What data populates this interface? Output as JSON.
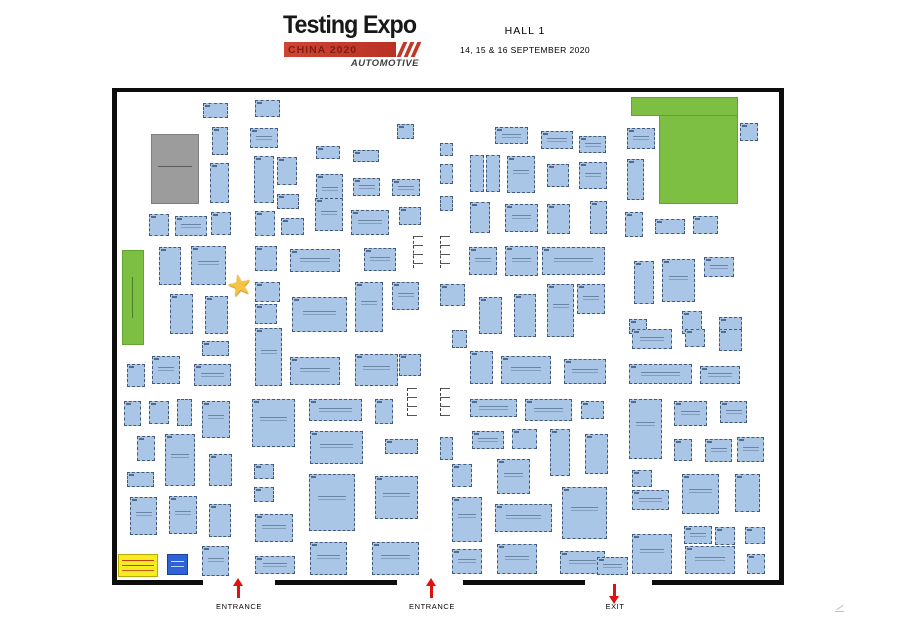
{
  "header": {
    "logo_title": "Testing Expo",
    "logo_banner": "CHINA 2020",
    "logo_sub": "AUTOMOTIVE",
    "hall": "HALL 1",
    "dates": "14, 15 & 16 SEPTEMBER 2020"
  },
  "colors": {
    "booth_fill": "#a9c6e6",
    "booth_border": "#47597a",
    "green_area": "#7cbf42",
    "gray_block": "#9c9c9c",
    "legend_yellow": "#f7ec20",
    "legend_blue": "#2e63d8",
    "arrow_red": "#e01111",
    "wall_black": "#0d0d0d"
  },
  "map": {
    "relaxation_label": "VISITOR\nRELAXATION\nAREA",
    "walls": [
      [
        112,
        88,
        672,
        4
      ],
      [
        112,
        88,
        5,
        497
      ],
      [
        779,
        88,
        5,
        497
      ],
      [
        112,
        580,
        91,
        5
      ],
      [
        275,
        580,
        122,
        5
      ],
      [
        463,
        580,
        122,
        5
      ],
      [
        652,
        580,
        132,
        5
      ]
    ],
    "zones": [
      {
        "name": "zone-organiser-block",
        "x": 151,
        "y": 134,
        "w": 48,
        "h": 70,
        "color": "#9c9c9c",
        "border": "#7e7e7e",
        "micro": "micro-h"
      },
      {
        "name": "zone-relaxation-strip",
        "x": 122,
        "y": 250,
        "w": 22,
        "h": 95,
        "color": "#7cbf42",
        "border": "#63a32f",
        "micro": "micro-v"
      },
      {
        "name": "zone-relaxation-top",
        "x": 631,
        "y": 97,
        "w": 107,
        "h": 19,
        "color": "#7cbf42",
        "border": "#63a32f",
        "micro": ""
      },
      {
        "name": "zone-relaxation-main",
        "x": 659,
        "y": 115,
        "w": 79,
        "h": 89,
        "color": "#7cbf42",
        "border": "#63a32f",
        "micro": ""
      },
      {
        "name": "zone-legend-yellow",
        "x": 118,
        "y": 554,
        "w": 40,
        "h": 23,
        "color": "#f7ec20",
        "border": "#b9a900",
        "micro": "micro-red"
      },
      {
        "name": "zone-legend-blue",
        "x": 167,
        "y": 554,
        "w": 21,
        "h": 21,
        "color": "#2e63d8",
        "border": "#1b3f9e",
        "micro": "micro-wht"
      }
    ],
    "joints": [
      [
        413,
        236,
        32
      ],
      [
        440,
        236,
        32
      ],
      [
        407,
        388,
        28
      ],
      [
        440,
        388,
        28
      ]
    ],
    "star": {
      "x": 227,
      "y": 272
    },
    "gates": [
      {
        "label": "ENTRANCE",
        "x": 239,
        "dir": "up"
      },
      {
        "label": "ENTRANCE",
        "x": 432,
        "dir": "up"
      },
      {
        "label": "EXIT",
        "x": 615,
        "dir": "down"
      }
    ],
    "booths": [
      [
        203,
        103,
        25,
        15
      ],
      [
        255,
        100,
        25,
        17
      ],
      [
        212,
        127,
        16,
        28
      ],
      [
        250,
        128,
        28,
        20
      ],
      [
        316,
        146,
        24,
        13
      ],
      [
        353,
        150,
        26,
        12
      ],
      [
        397,
        124,
        17,
        15
      ],
      [
        210,
        163,
        19,
        40
      ],
      [
        254,
        156,
        20,
        47
      ],
      [
        277,
        157,
        20,
        28
      ],
      [
        316,
        174,
        27,
        33
      ],
      [
        353,
        178,
        27,
        18
      ],
      [
        392,
        179,
        28,
        17
      ],
      [
        440,
        143,
        13,
        13
      ],
      [
        440,
        164,
        13,
        20
      ],
      [
        315,
        198,
        28,
        33
      ],
      [
        351,
        210,
        38,
        25
      ],
      [
        399,
        207,
        22,
        18
      ],
      [
        277,
        194,
        22,
        15
      ],
      [
        440,
        196,
        13,
        15
      ],
      [
        149,
        214,
        20,
        22
      ],
      [
        175,
        216,
        32,
        20
      ],
      [
        211,
        212,
        20,
        23
      ],
      [
        255,
        211,
        20,
        25
      ],
      [
        281,
        218,
        23,
        17
      ],
      [
        159,
        247,
        22,
        38
      ],
      [
        191,
        246,
        35,
        39
      ],
      [
        255,
        246,
        22,
        25
      ],
      [
        290,
        249,
        50,
        23
      ],
      [
        364,
        248,
        32,
        23
      ],
      [
        170,
        294,
        23,
        40
      ],
      [
        205,
        296,
        23,
        38
      ],
      [
        255,
        282,
        25,
        20
      ],
      [
        255,
        304,
        22,
        20
      ],
      [
        292,
        297,
        55,
        35
      ],
      [
        355,
        282,
        28,
        50
      ],
      [
        392,
        282,
        27,
        28
      ],
      [
        440,
        284,
        25,
        22
      ],
      [
        495,
        127,
        33,
        17
      ],
      [
        541,
        131,
        32,
        18
      ],
      [
        579,
        136,
        27,
        17
      ],
      [
        627,
        128,
        28,
        21
      ],
      [
        740,
        123,
        18,
        18
      ],
      [
        470,
        155,
        14,
        37
      ],
      [
        486,
        155,
        14,
        37
      ],
      [
        507,
        156,
        28,
        37
      ],
      [
        547,
        164,
        22,
        23
      ],
      [
        579,
        162,
        28,
        27
      ],
      [
        627,
        159,
        17,
        41
      ],
      [
        470,
        202,
        20,
        31
      ],
      [
        505,
        204,
        33,
        28
      ],
      [
        547,
        204,
        23,
        30
      ],
      [
        590,
        201,
        17,
        33
      ],
      [
        625,
        212,
        18,
        25
      ],
      [
        655,
        219,
        30,
        15
      ],
      [
        693,
        216,
        25,
        18
      ],
      [
        469,
        247,
        28,
        28
      ],
      [
        505,
        246,
        33,
        30
      ],
      [
        542,
        247,
        63,
        28
      ],
      [
        634,
        261,
        20,
        43
      ],
      [
        662,
        259,
        33,
        43
      ],
      [
        704,
        257,
        30,
        20
      ],
      [
        479,
        297,
        23,
        37
      ],
      [
        514,
        294,
        22,
        43
      ],
      [
        547,
        284,
        27,
        53
      ],
      [
        577,
        284,
        28,
        30
      ],
      [
        682,
        311,
        20,
        23
      ],
      [
        719,
        317,
        23,
        17
      ],
      [
        629,
        319,
        18,
        15
      ],
      [
        202,
        341,
        27,
        15
      ],
      [
        152,
        356,
        28,
        28
      ],
      [
        127,
        364,
        18,
        23
      ],
      [
        194,
        364,
        37,
        22
      ],
      [
        124,
        401,
        17,
        25
      ],
      [
        149,
        401,
        20,
        23
      ],
      [
        177,
        399,
        15,
        27
      ],
      [
        202,
        401,
        28,
        37
      ],
      [
        137,
        436,
        18,
        25
      ],
      [
        165,
        434,
        30,
        52
      ],
      [
        209,
        454,
        23,
        32
      ],
      [
        127,
        472,
        27,
        15
      ],
      [
        130,
        497,
        27,
        38
      ],
      [
        169,
        496,
        28,
        38
      ],
      [
        209,
        504,
        22,
        33
      ],
      [
        202,
        546,
        27,
        30
      ],
      [
        255,
        328,
        27,
        58
      ],
      [
        290,
        357,
        50,
        28
      ],
      [
        355,
        354,
        43,
        32
      ],
      [
        399,
        354,
        22,
        22
      ],
      [
        252,
        399,
        43,
        48
      ],
      [
        309,
        399,
        53,
        22
      ],
      [
        375,
        399,
        18,
        25
      ],
      [
        310,
        431,
        53,
        33
      ],
      [
        385,
        439,
        33,
        15
      ],
      [
        254,
        464,
        20,
        15
      ],
      [
        254,
        487,
        20,
        15
      ],
      [
        309,
        474,
        46,
        57
      ],
      [
        375,
        476,
        43,
        43
      ],
      [
        255,
        514,
        38,
        28
      ],
      [
        310,
        542,
        37,
        33
      ],
      [
        255,
        556,
        40,
        18
      ],
      [
        372,
        542,
        47,
        33
      ],
      [
        632,
        329,
        40,
        20
      ],
      [
        685,
        329,
        20,
        18
      ],
      [
        719,
        329,
        23,
        22
      ],
      [
        629,
        364,
        63,
        20
      ],
      [
        700,
        366,
        40,
        18
      ],
      [
        470,
        351,
        23,
        33
      ],
      [
        501,
        356,
        50,
        28
      ],
      [
        564,
        359,
        42,
        25
      ],
      [
        452,
        330,
        15,
        18
      ],
      [
        470,
        399,
        47,
        18
      ],
      [
        525,
        399,
        47,
        22
      ],
      [
        581,
        401,
        23,
        18
      ],
      [
        472,
        431,
        32,
        18
      ],
      [
        512,
        429,
        25,
        20
      ],
      [
        550,
        429,
        20,
        47
      ],
      [
        585,
        434,
        23,
        40
      ],
      [
        440,
        437,
        13,
        23
      ],
      [
        497,
        459,
        33,
        35
      ],
      [
        452,
        464,
        20,
        23
      ],
      [
        562,
        487,
        45,
        52
      ],
      [
        495,
        504,
        57,
        28
      ],
      [
        452,
        497,
        30,
        45
      ],
      [
        497,
        544,
        40,
        30
      ],
      [
        560,
        551,
        45,
        23
      ],
      [
        452,
        549,
        30,
        25
      ],
      [
        597,
        557,
        31,
        18
      ],
      [
        629,
        399,
        33,
        60
      ],
      [
        674,
        401,
        33,
        25
      ],
      [
        720,
        401,
        27,
        22
      ],
      [
        674,
        439,
        18,
        22
      ],
      [
        705,
        439,
        27,
        23
      ],
      [
        737,
        437,
        27,
        25
      ],
      [
        632,
        470,
        20,
        17
      ],
      [
        682,
        474,
        37,
        40
      ],
      [
        735,
        474,
        25,
        38
      ],
      [
        632,
        490,
        37,
        20
      ],
      [
        684,
        526,
        28,
        18
      ],
      [
        715,
        527,
        20,
        18
      ],
      [
        745,
        527,
        20,
        17
      ],
      [
        632,
        534,
        40,
        40
      ],
      [
        685,
        546,
        50,
        28
      ],
      [
        747,
        554,
        18,
        20
      ]
    ]
  }
}
